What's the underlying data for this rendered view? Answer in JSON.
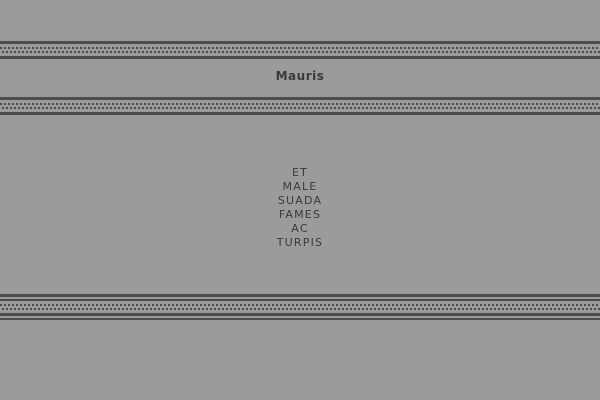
{
  "page": {
    "background_color": "#9b9b9b",
    "ornament_color": "#4c4c4c",
    "text_color": "#3a3a3a"
  },
  "header": {
    "title": "Mauris"
  },
  "content": {
    "text": "ET MALE SUADA FAMES AC TURPIS",
    "lines": [
      "ET",
      "MALE",
      "SUADA",
      "FAMES",
      "AC",
      "TURPIS"
    ]
  }
}
